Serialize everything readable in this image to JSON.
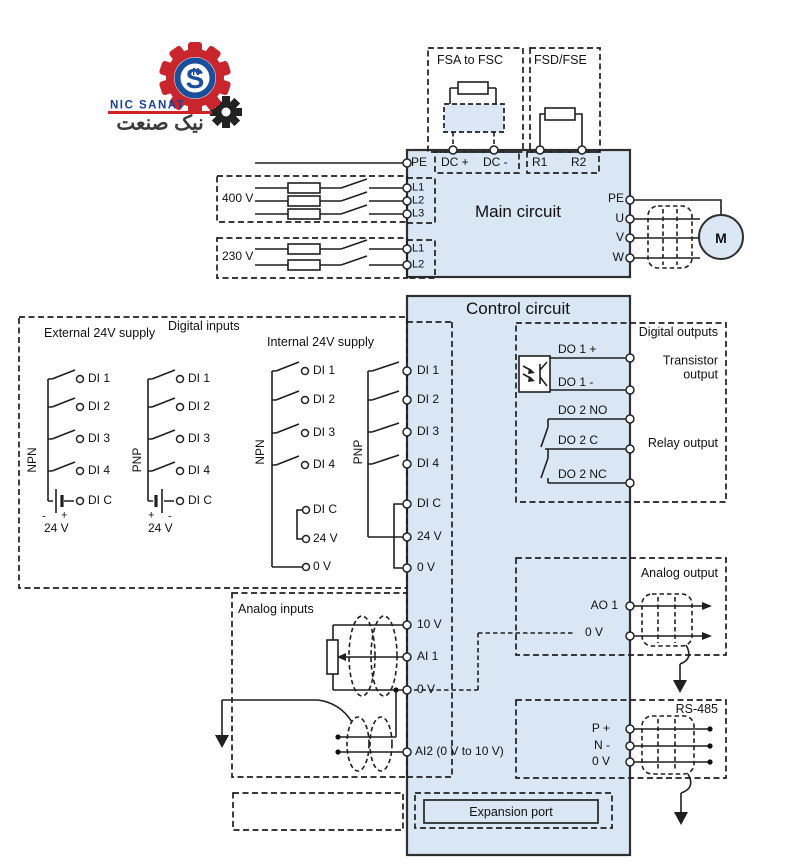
{
  "logo": {
    "name_en": "NIC SANAT",
    "name_fa": "نیک صنعت",
    "monogram": "S",
    "monogram_small": "N"
  },
  "braking": {
    "fsa": "FSA to FSC",
    "fsd": "FSD/FSE"
  },
  "main": {
    "title": "Main circuit",
    "top_terminals": {
      "pe": "PE",
      "dcp": "DC +",
      "dcm": "DC -",
      "r1": "R1",
      "r2": "R2"
    },
    "supply_400": {
      "label": "400 V",
      "l1": "L1",
      "l2": "L2",
      "l3": "L3"
    },
    "supply_230": {
      "label": "230 V",
      "l1": "L1",
      "l2": "L2"
    },
    "output": {
      "pe": "PE",
      "u": "U",
      "v": "V",
      "w": "W",
      "motor": "M"
    }
  },
  "control": {
    "title": "Control circuit",
    "din": {
      "section": "Digital inputs",
      "external": "External 24V supply",
      "internal": "Internal 24V supply",
      "npn": "NPN",
      "pnp": "PNP",
      "di1": "DI 1",
      "di2": "DI 2",
      "di3": "DI 3",
      "di4": "DI 4",
      "dic": "DI C",
      "v24": "24 V",
      "v0": "0 V",
      "plus": "+",
      "minus": "-"
    },
    "terminals": {
      "di1": "DI 1",
      "di2": "DI 2",
      "di3": "DI 3",
      "di4": "DI 4",
      "dic": "DI C",
      "v24": "24 V",
      "v0": "0 V",
      "v10": "10 V",
      "ai1": "AI 1",
      "ai2": "AI2 (0 V to 10 V)"
    },
    "dout": {
      "section": "Digital outputs",
      "transistor": "Transistor output",
      "relay": "Relay output",
      "do1p": "DO 1 +",
      "do1m": "DO 1 -",
      "do2no": "DO 2 NO",
      "do2c": "DO 2 C",
      "do2nc": "DO 2 NC"
    },
    "aout": {
      "section": "Analog output",
      "ao1": "AO 1",
      "v0": "0 V"
    },
    "rs485": {
      "section": "RS-485",
      "p": "P +",
      "n": "N -",
      "v0": "0 V"
    },
    "ain": {
      "section": "Analog inputs"
    },
    "expansion": "Expansion port"
  }
}
